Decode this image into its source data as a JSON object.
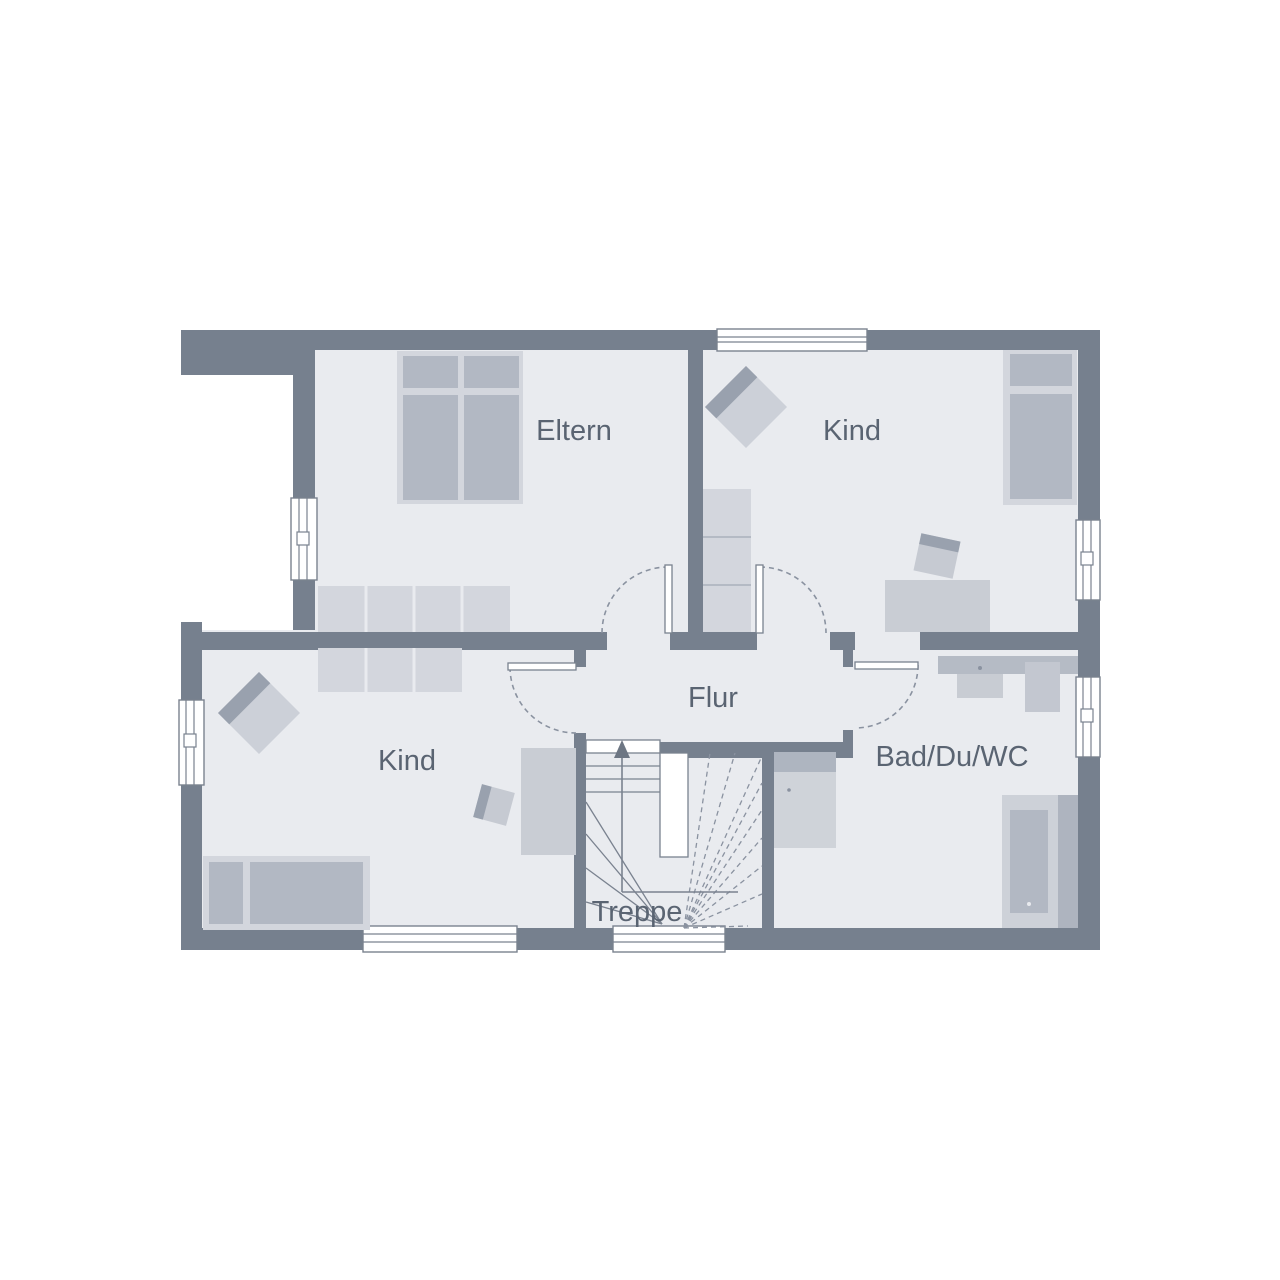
{
  "rooms": {
    "eltern": {
      "label": "Eltern"
    },
    "kind_top": {
      "label": "Kind"
    },
    "kind_bottom": {
      "label": "Kind"
    },
    "flur": {
      "label": "Flur"
    },
    "bad": {
      "label": "Bad/Du/WC"
    },
    "treppe": {
      "label": "Treppe"
    }
  },
  "colors": {
    "wall": "#76808e",
    "floor": "#e9ebef",
    "label": "#5a6472",
    "furniture_light": "#d3d6dd",
    "furniture_mid": "#b2b8c3",
    "furniture_dark": "#99a1ae",
    "desk": "#c9cdd4",
    "counter": "#b5bbc5",
    "sink": "#c8ccd3",
    "shower": "#c3c7d0",
    "toilet_body": "#cfd3d9",
    "toilet_band": "#aeb5c0",
    "tub_outer": "#cdd1d8",
    "tub_basin": "#b2b8c3",
    "tub_strip": "#aeb4bf",
    "armchair": "#ccd0d8",
    "chair": "#c6cad2",
    "line": "#7a828f",
    "dash": "#8a92a0",
    "white": "#ffffff"
  }
}
